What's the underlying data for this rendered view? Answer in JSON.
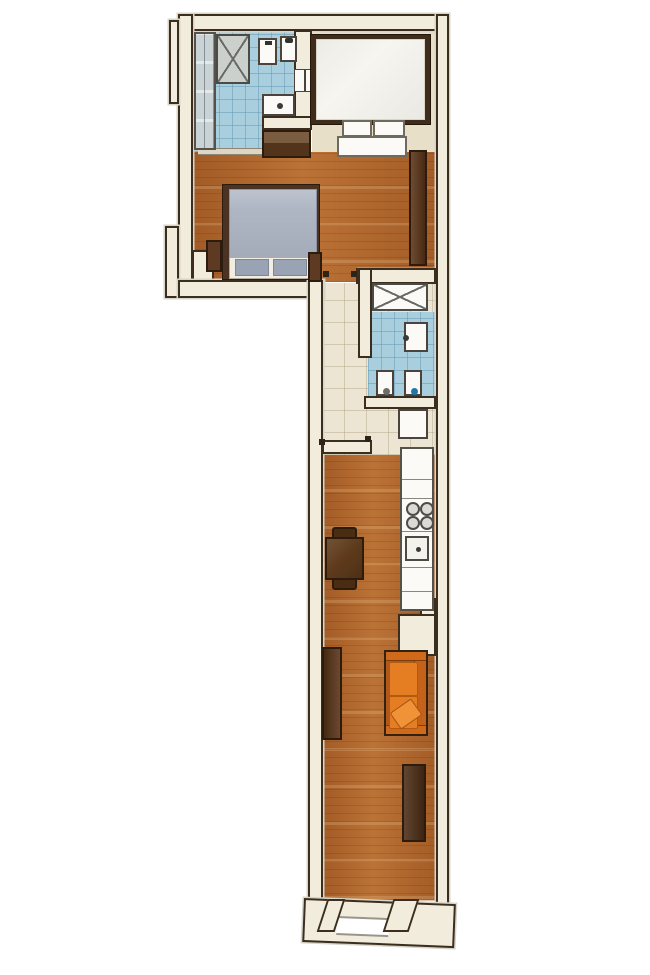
{
  "plan": {
    "type": "apartment-floor-plan",
    "style": "rendered-top-view",
    "orientation": "tall-narrow-L-shape",
    "visible_text": "none",
    "rooms": [
      {
        "name": "bathroom",
        "position": "top-left",
        "floor": "light-blue-tile",
        "items": [
          "glass-shower-screen",
          "shower-tray-x",
          "toilet",
          "wall-hung-basin",
          "washing-machine",
          "wall-niche-shelf"
        ]
      },
      {
        "name": "bedroom-alcove",
        "position": "top-right",
        "floor": "beige-carpet",
        "items": [
          "double-bed-white",
          "cushion-bench"
        ]
      },
      {
        "name": "master-bedroom",
        "position": "upper-middle",
        "floor": "hardwood-planks",
        "items": [
          "chest-of-drawers",
          "double-bed-gray",
          "nightstand-left",
          "nightstand-right",
          "wardrobe"
        ]
      },
      {
        "name": "hallway",
        "position": "center",
        "floor": "beige-ceramic-tile",
        "items": [
          "built-in-closet-x"
        ]
      },
      {
        "name": "wc",
        "position": "center-right",
        "floor": "light-blue-tile",
        "items": [
          "washbasin",
          "toilet",
          "bidet"
        ]
      },
      {
        "name": "kitchen",
        "position": "lower-middle",
        "floor": "hardwood-planks",
        "items": [
          "refrigerator",
          "kitchen-counter",
          "cooktop-four-burners",
          "kitchen-sink",
          "dining-table",
          "chair-top",
          "chair-bottom"
        ]
      },
      {
        "name": "living-room",
        "position": "bottom",
        "floor": "hardwood-planks",
        "items": [
          "sideboard",
          "orange-sofa",
          "throw-cushion",
          "tv-cabinet",
          "entry-door-opening"
        ]
      }
    ],
    "colors": {
      "background": "#ffffff",
      "wall_fill": "#f2ecdc",
      "wall_line": "#3c2e1f",
      "wood": "#b1662c",
      "tile_blue": "#a9cfdf",
      "tile_beige": "#ece5d3",
      "carpet": "#e8dfc9",
      "furn": "#5d3a21",
      "furn_line": "#2d1c0d",
      "fixture_white": "#fbfaf6",
      "shower_gray": "#ccd0cc",
      "glass_gray": "#c9d2d5",
      "sofa_orange": "#e57d22",
      "sofa_dark": "#b3581a",
      "bed_duvet_gray": "#aeb6c4",
      "bed_pillow_gray": "#99a3b3"
    }
  }
}
